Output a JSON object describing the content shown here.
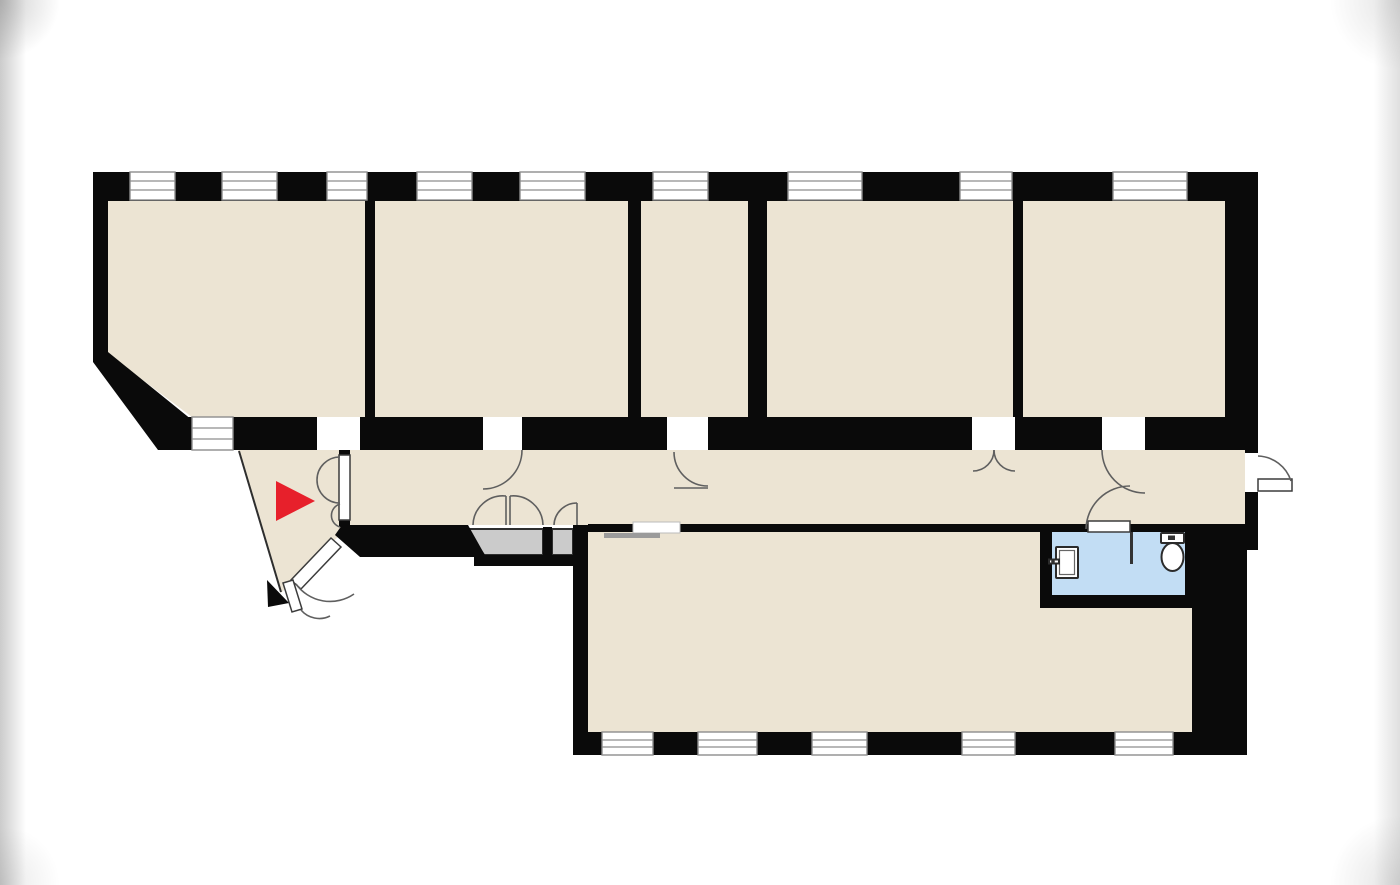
{
  "page": {
    "type": "Apartment floor plan",
    "width": 1400,
    "height": 885,
    "background": "#ffffff"
  },
  "colors": {
    "wall": "#0a0a0a",
    "room_fill": "#ece4d3",
    "bathroom_fill": "#c2ddf4",
    "closet_fill": "#cbcbcb",
    "window_fill": "#ffffff",
    "window_frame": "#8d8d8d",
    "door_stroke": "#5f5f5f",
    "door_leaf_stroke": "#3c3c3c",
    "fixture_fill": "#ffffff",
    "fixture_stroke": "#2b2b2b",
    "slider_fill": "#9b9b9b",
    "entrance_arrow": "#e7202b",
    "outline": "#2e2e2e"
  },
  "structure": {
    "rooms": [
      {
        "name": "room-1",
        "kind": "room, chamfered bottom-left corner"
      },
      {
        "name": "room-2",
        "kind": "room"
      },
      {
        "name": "room-3",
        "kind": "narrow room"
      },
      {
        "name": "room-4",
        "kind": "room"
      },
      {
        "name": "room-5",
        "kind": "room"
      },
      {
        "name": "corridor",
        "kind": "hallway"
      },
      {
        "name": "entrance-vestibule",
        "kind": "triangular entry with red arrow"
      },
      {
        "name": "main-room",
        "kind": "large bottom room"
      },
      {
        "name": "bathroom",
        "kind": "wc with toilet and sink"
      },
      {
        "name": "closet-left",
        "kind": "storage"
      },
      {
        "name": "closet-right",
        "kind": "storage"
      }
    ],
    "window_count": 15,
    "doors": [
      "vestibule-double-door",
      "entrance-door",
      "door-room-2",
      "door-room-3",
      "double-door-room-4",
      "door-room-5",
      "bathroom-door",
      "closet-double-door",
      "closet-small-door",
      "exterior-door-right",
      "sliding-door-main-room"
    ],
    "fixtures": [
      {
        "name": "toilet-icon"
      },
      {
        "name": "sink-icon"
      },
      {
        "name": "entrance-arrow-icon"
      }
    ]
  }
}
